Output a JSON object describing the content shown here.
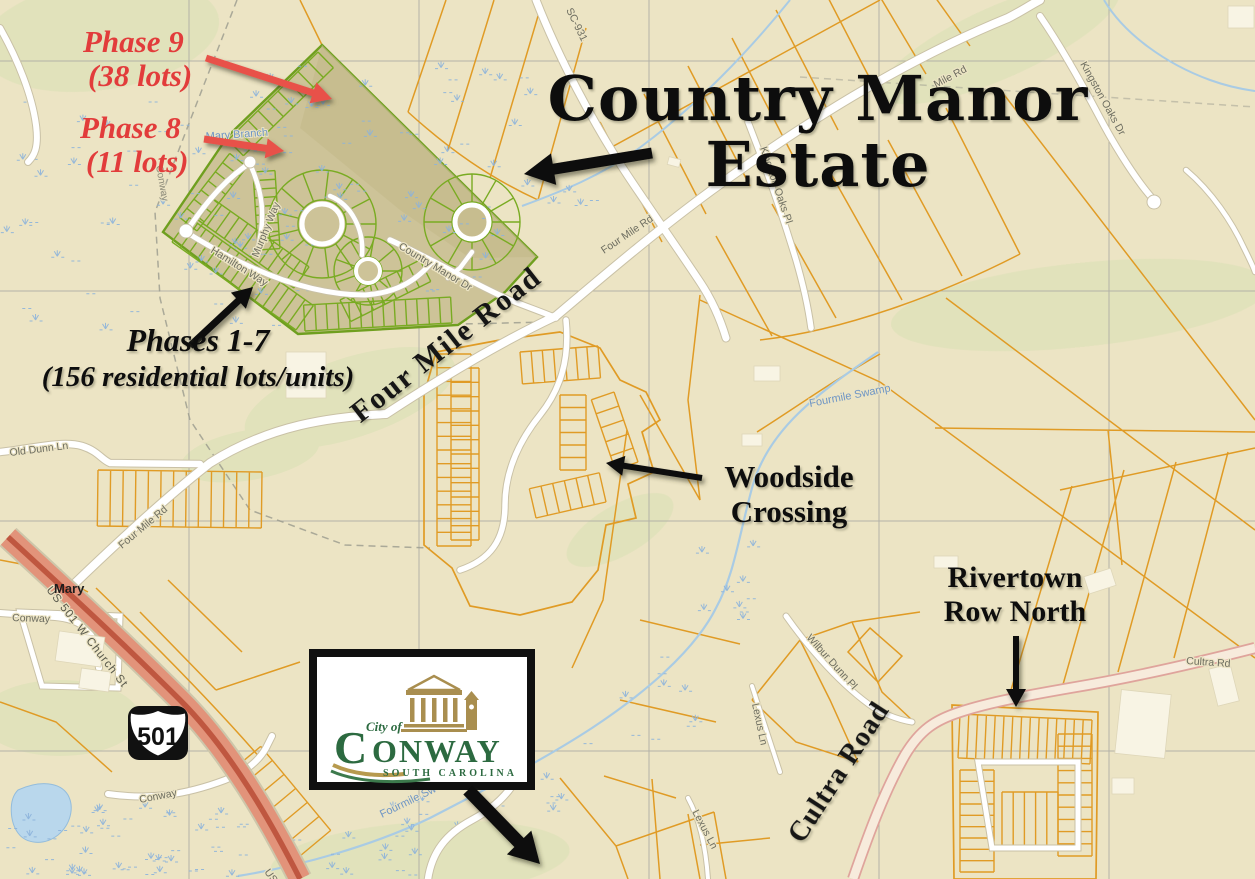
{
  "title": {
    "line1": "Country Manor",
    "line2": "Estate"
  },
  "callouts": {
    "phase9": {
      "line1": "Phase 9",
      "line2": "(38 lots)"
    },
    "phase8": {
      "line1": "Phase 8",
      "line2": "(11 lots)"
    },
    "phases_1_7": {
      "line1": "Phases 1-7",
      "line2": "(156 residential lots/units)"
    },
    "woodside": {
      "line1": "Woodside",
      "line2": "Crossing"
    },
    "rivertown": {
      "line1": "Rivertown",
      "line2": "Row North"
    }
  },
  "major_road_labels": {
    "four_mile_road": "Four Mile Road",
    "cultra_road": "Cultra Road"
  },
  "minor_road_labels": {
    "sc_931": "SC-931",
    "four_mile_rd_ne": "Four Mile Rd",
    "four_mile_rd_far_ne": "Mile Rd",
    "four_mile_rd_sw": "Four Mile Rd",
    "old_dunn_ln": "Old Dunn Ln",
    "kingston_oaks_pl": "Kingston Oaks Pl",
    "kingston_oaks_dr": "Kingston Oaks Dr",
    "us_501_w_church_st": "US 501 W Church St",
    "us_fragment": "US",
    "conway_west": "Conway",
    "conway_south": "Conway",
    "conway_boundary": "Conway",
    "cultra_rd_small": "Cultra Rd",
    "wilbur_dunn_pl": "Wilbur Dunn Pl",
    "lexus_ln_north": "Lexus Ln",
    "lexus_ln_south": "Lexus Ln",
    "country_manor_dr": "Country Manor Dr",
    "hamilton_way": "Hamilton Way",
    "murphy_way": "Murphy Way"
  },
  "water_labels": {
    "mary_branch": "Mary Branch",
    "fourmile_swamp": "Fourmile Swamp",
    "fourmile_swamp_sw": "Fourmile Sw"
  },
  "place_labels": {
    "mary": "Mary"
  },
  "highway_shield": {
    "route": "501"
  },
  "conway_logo": {
    "city_of": "City of",
    "name_initial": "C",
    "name_rest": "ONWAY",
    "state": "SOUTH CAROLINA"
  },
  "colors": {
    "map_bg": "#ece4c4",
    "parcel_orange": "#e09b25",
    "plat_green": "#6f9f1f",
    "plat_fill": "#cdc398",
    "highway_salmon": "#e2937a",
    "highway_core": "#bf5740",
    "road_white": "#ffffff",
    "water_blue": "#a9cbe4",
    "annotation_red": "#e23c3b",
    "annotation_black": "#111111",
    "label_gray": "#6d6d60",
    "logo_green": "#2c6a40",
    "logo_gold": "#a98e4f"
  }
}
